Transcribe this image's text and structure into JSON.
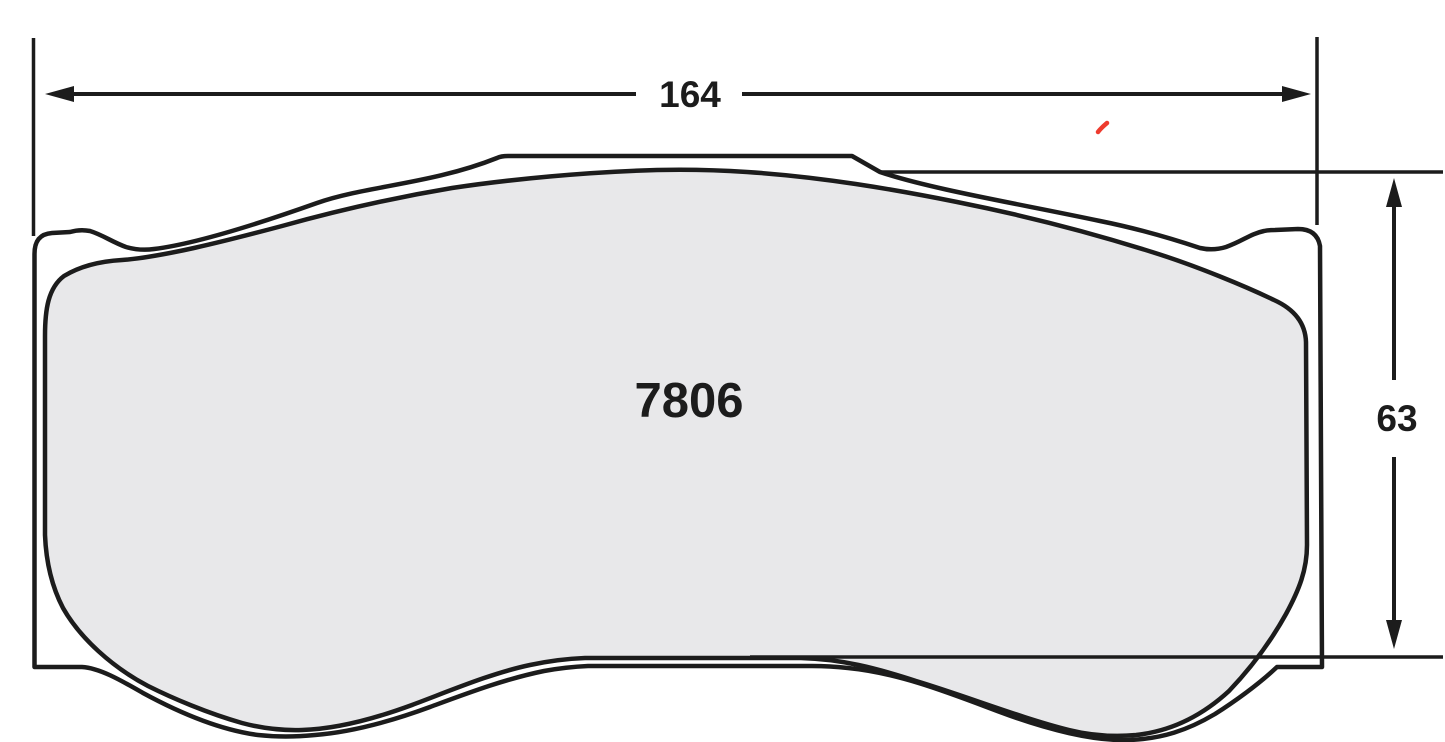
{
  "drawing": {
    "part_number": "7806",
    "dimensions": {
      "width": "164",
      "height": "63"
    },
    "colors": {
      "outline": "#1c1c1c",
      "friction_fill": "#e8e8ea",
      "background": "#ffffff",
      "red_mark": "#ee3b2e"
    }
  }
}
